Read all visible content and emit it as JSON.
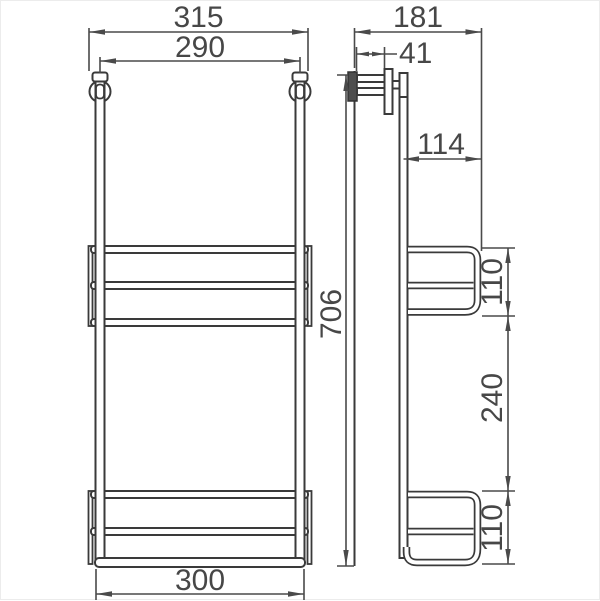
{
  "drawing": {
    "kind": "technical dimension drawing",
    "product": "wall-mounted two-tier towel rack",
    "background": "#ffffff",
    "line_color": "#3a3a3a",
    "text_color": "#474747",
    "views": {
      "front": {
        "label": "front-view"
      },
      "side": {
        "label": "side-view"
      }
    },
    "dimensions": {
      "overall_width": "315",
      "hook_spacing": "290",
      "bottom_width": "300",
      "overall_height": "706",
      "overall_depth": "181",
      "wall_arm_length": "41",
      "basket_depth": "114",
      "upper_basket_height": "110",
      "rail_gap": "240",
      "lower_basket_height": "110"
    }
  }
}
